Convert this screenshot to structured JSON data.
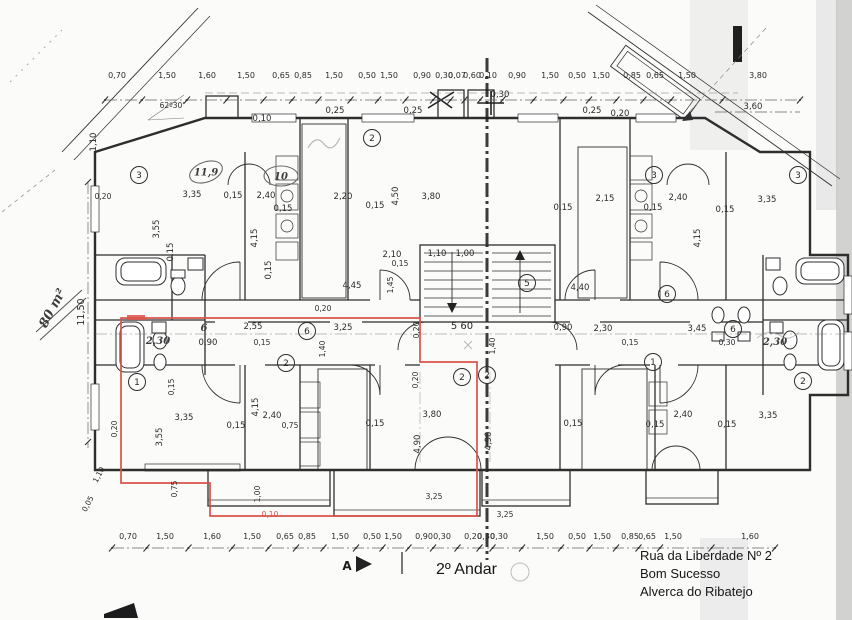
{
  "title_block": {
    "floor": "2º Andar",
    "address_line1": "Rua da Liberdade Nº 2",
    "address_line2": "Bom Sucesso",
    "address_line3": "Alverca do Ribatejo"
  },
  "annotations": {
    "area_note": "80 m²",
    "angle_note": "62º30'",
    "section_letter": "A"
  },
  "colors": {
    "ink": "#2e2e2e",
    "red_outline": "#d9534a",
    "paper": "#fbfbfa",
    "pencil": "#8a8a8a"
  },
  "plan": {
    "dim_chains": {
      "top": {
        "x1": 105,
        "x2": 800,
        "y_line": 100,
        "y_text": 78,
        "items": [
          {
            "v": "0,70",
            "x": 117
          },
          {
            "v": "1,50",
            "x": 167
          },
          {
            "v": "1,60",
            "x": 207
          },
          {
            "v": "1,50",
            "x": 246
          },
          {
            "v": "0,65",
            "x": 281
          },
          {
            "v": "0,85",
            "x": 303
          },
          {
            "v": "1,50",
            "x": 334
          },
          {
            "v": "0,50",
            "x": 367
          },
          {
            "v": "1,50",
            "x": 389
          },
          {
            "v": "0,90",
            "x": 422
          },
          {
            "v": "0,30",
            "x": 444
          },
          {
            "v": "0,07",
            "x": 457
          },
          {
            "v": "0,60",
            "x": 472
          },
          {
            "v": "0,10",
            "x": 488
          },
          {
            "v": "0,90",
            "x": 517
          },
          {
            "v": "1,50",
            "x": 550
          },
          {
            "v": "0,50",
            "x": 577
          },
          {
            "v": "1,50",
            "x": 601
          },
          {
            "v": "0,85",
            "x": 632
          },
          {
            "v": "0,65",
            "x": 655
          },
          {
            "v": "1,50",
            "x": 687
          },
          {
            "v": "3,80",
            "x": 758
          }
        ]
      },
      "bottom": {
        "x1": 112,
        "x2": 775,
        "y_line": 548,
        "y_text": 539,
        "items": [
          {
            "v": "0,70",
            "x": 128
          },
          {
            "v": "1,50",
            "x": 165
          },
          {
            "v": "1,60",
            "x": 212
          },
          {
            "v": "1,50",
            "x": 252
          },
          {
            "v": "0,65",
            "x": 285
          },
          {
            "v": "0,85",
            "x": 307
          },
          {
            "v": "1,50",
            "x": 340
          },
          {
            "v": "0,50",
            "x": 372
          },
          {
            "v": "1,50",
            "x": 393
          },
          {
            "v": "0,90",
            "x": 424
          },
          {
            "v": "0,30",
            "x": 442
          },
          {
            "v": "0,20",
            "x": 473
          },
          {
            "v": "0,30",
            "x": 486
          },
          {
            "v": "0,30",
            "x": 499
          },
          {
            "v": "1,50",
            "x": 545
          },
          {
            "v": "0,50",
            "x": 577
          },
          {
            "v": "1,50",
            "x": 602
          },
          {
            "v": "0,85",
            "x": 630
          },
          {
            "v": "0,65",
            "x": 647
          },
          {
            "v": "1,50",
            "x": 673
          },
          {
            "v": "1,60",
            "x": 750
          }
        ]
      }
    },
    "labels": [
      {
        "t": "0,10",
        "x": 262,
        "y": 121
      },
      {
        "t": "0,25",
        "x": 335,
        "y": 113
      },
      {
        "t": "0,25",
        "x": 413,
        "y": 113
      },
      {
        "t": "0,25",
        "x": 592,
        "y": 113
      },
      {
        "t": "0,20",
        "x": 620,
        "y": 116
      },
      {
        "t": "0,30",
        "x": 500,
        "y": 97
      },
      {
        "t": "3,60",
        "x": 753,
        "y": 109
      },
      {
        "t": "62º30'",
        "x": 172,
        "y": 108,
        "s": 7.5
      },
      {
        "t": "1,10",
        "x": 96,
        "y": 142,
        "r": -90
      },
      {
        "t": "0,20",
        "x": 103,
        "y": 199,
        "s": 7.5
      },
      {
        "t": "11,50",
        "x": 84,
        "y": 312,
        "r": -90,
        "s": 9.5
      },
      {
        "t": "80 m²",
        "x": 56,
        "y": 310,
        "r": -62,
        "c": "hand",
        "s": 13
      },
      {
        "t": "3,35",
        "x": 192,
        "y": 197
      },
      {
        "t": "0,15",
        "x": 233,
        "y": 198
      },
      {
        "t": "2,40",
        "x": 266,
        "y": 198
      },
      {
        "t": "0,15",
        "x": 283,
        "y": 211
      },
      {
        "t": "3,55",
        "x": 159,
        "y": 229,
        "r": -90
      },
      {
        "t": "4,15",
        "x": 257,
        "y": 238,
        "r": -90
      },
      {
        "t": "0,15",
        "x": 173,
        "y": 252,
        "r": -90
      },
      {
        "t": "0,15",
        "x": 271,
        "y": 270,
        "r": -90
      },
      {
        "t": "2,20",
        "x": 343,
        "y": 199
      },
      {
        "t": "0,15",
        "x": 375,
        "y": 208
      },
      {
        "t": "4,50",
        "x": 398,
        "y": 196,
        "r": -90
      },
      {
        "t": "3,80",
        "x": 431,
        "y": 199
      },
      {
        "t": "2,10",
        "x": 392,
        "y": 257
      },
      {
        "t": "0,15",
        "x": 400,
        "y": 266,
        "s": 7.5
      },
      {
        "t": "1,10",
        "x": 437,
        "y": 256
      },
      {
        "t": "1,00",
        "x": 465,
        "y": 256
      },
      {
        "t": "1,45",
        "x": 393,
        "y": 285,
        "r": -90,
        "s": 7.5
      },
      {
        "t": "4,45",
        "x": 352,
        "y": 288
      },
      {
        "t": "2,15",
        "x": 605,
        "y": 201
      },
      {
        "t": "0,15",
        "x": 563,
        "y": 210
      },
      {
        "t": "2,40",
        "x": 678,
        "y": 200
      },
      {
        "t": "0,15",
        "x": 653,
        "y": 210
      },
      {
        "t": "3,35",
        "x": 767,
        "y": 202
      },
      {
        "t": "0,15",
        "x": 725,
        "y": 212
      },
      {
        "t": "4,15",
        "x": 700,
        "y": 238,
        "r": -90
      },
      {
        "t": "4,40",
        "x": 580,
        "y": 290
      },
      {
        "t": "6",
        "x": 204,
        "y": 331,
        "c": "hand",
        "s": 10
      },
      {
        "t": "2,55",
        "x": 253,
        "y": 329
      },
      {
        "t": "0,90",
        "x": 208,
        "y": 345
      },
      {
        "t": "2,30",
        "x": 158,
        "y": 344,
        "c": "hand",
        "s": 10
      },
      {
        "t": "0,15",
        "x": 262,
        "y": 345,
        "s": 7.5
      },
      {
        "t": "3,25",
        "x": 343,
        "y": 330
      },
      {
        "t": "1,40",
        "x": 325,
        "y": 349,
        "r": -90,
        "s": 7.5
      },
      {
        "t": "0,20",
        "x": 419,
        "y": 330,
        "r": -90,
        "s": 7.5
      },
      {
        "t": "5 60",
        "x": 462,
        "y": 329,
        "s": 10
      },
      {
        "t": "1,40",
        "x": 495,
        "y": 346,
        "r": -90,
        "s": 7.5
      },
      {
        "t": "0,90",
        "x": 563,
        "y": 330
      },
      {
        "t": "2,30",
        "x": 603,
        "y": 331
      },
      {
        "t": "3,45",
        "x": 697,
        "y": 331
      },
      {
        "t": "0,15",
        "x": 630,
        "y": 345,
        "s": 7.5
      },
      {
        "t": "0,30",
        "x": 727,
        "y": 345,
        "s": 7.5
      },
      {
        "t": "2,30",
        "x": 775,
        "y": 345,
        "c": "hand",
        "s": 10
      },
      {
        "t": "0,15",
        "x": 174,
        "y": 387,
        "r": -90,
        "s": 7.5
      },
      {
        "t": "0,20",
        "x": 323,
        "y": 311,
        "s": 7.5
      },
      {
        "t": "0,20",
        "x": 117,
        "y": 429,
        "r": -90,
        "s": 7.5
      },
      {
        "t": "3,35",
        "x": 184,
        "y": 420
      },
      {
        "t": "3,55",
        "x": 162,
        "y": 437,
        "r": -90
      },
      {
        "t": "0,15",
        "x": 236,
        "y": 428
      },
      {
        "t": "4,15",
        "x": 258,
        "y": 407,
        "r": -90
      },
      {
        "t": "2,40",
        "x": 272,
        "y": 418
      },
      {
        "t": "0,75",
        "x": 290,
        "y": 428,
        "s": 7.5
      },
      {
        "t": "0,75",
        "x": 177,
        "y": 489,
        "r": -90,
        "s": 7.5
      },
      {
        "t": "1,00",
        "x": 260,
        "y": 494,
        "r": -90,
        "s": 7.5
      },
      {
        "t": "0,10",
        "x": 270,
        "y": 517,
        "c": "red",
        "s": 7.5
      },
      {
        "t": "0,20",
        "x": 418,
        "y": 380,
        "r": -90,
        "s": 7.5
      },
      {
        "t": "3,80",
        "x": 432,
        "y": 417
      },
      {
        "t": "0,15",
        "x": 375,
        "y": 426
      },
      {
        "t": "4,90",
        "x": 420,
        "y": 444,
        "r": -90
      },
      {
        "t": "4,90",
        "x": 491,
        "y": 441,
        "r": -90
      },
      {
        "t": "3,25",
        "x": 434,
        "y": 499,
        "s": 7.5
      },
      {
        "t": "3,25",
        "x": 505,
        "y": 517,
        "s": 7.5
      },
      {
        "t": "2,40",
        "x": 683,
        "y": 417
      },
      {
        "t": "0,15",
        "x": 655,
        "y": 427
      },
      {
        "t": "3,35",
        "x": 768,
        "y": 418
      },
      {
        "t": "0,15",
        "x": 727,
        "y": 427
      },
      {
        "t": "0,15",
        "x": 573,
        "y": 426
      },
      {
        "t": "1,10",
        "x": 101,
        "y": 476,
        "r": -62,
        "s": 7.5
      },
      {
        "t": "0,05",
        "x": 90,
        "y": 505,
        "r": -62,
        "s": 7.5
      },
      {
        "t": "A",
        "x": 347,
        "y": 570,
        "s": 12,
        "c": "bold"
      }
    ],
    "room_circles": [
      {
        "n": "3",
        "x": 139,
        "y": 175
      },
      {
        "n": "2",
        "x": 372,
        "y": 138
      },
      {
        "n": "3",
        "x": 654,
        "y": 175
      },
      {
        "n": "3",
        "x": 798,
        "y": 175
      },
      {
        "n": "6",
        "x": 307,
        "y": 331
      },
      {
        "n": "5",
        "x": 527,
        "y": 283
      },
      {
        "n": "6",
        "x": 733,
        "y": 329
      },
      {
        "n": "6",
        "x": 667,
        "y": 294
      },
      {
        "n": "2",
        "x": 286,
        "y": 363
      },
      {
        "n": "1",
        "x": 137,
        "y": 382
      },
      {
        "n": "1",
        "x": 653,
        "y": 362
      },
      {
        "n": "2",
        "x": 462,
        "y": 377
      },
      {
        "n": "2",
        "x": 487,
        "y": 375
      },
      {
        "n": "2",
        "x": 803,
        "y": 381
      }
    ],
    "hand_ovals": [
      {
        "t": "11,9",
        "x": 206,
        "y": 172,
        "r": -20
      },
      {
        "t": "10",
        "x": 281,
        "y": 176,
        "r": 0
      }
    ]
  }
}
